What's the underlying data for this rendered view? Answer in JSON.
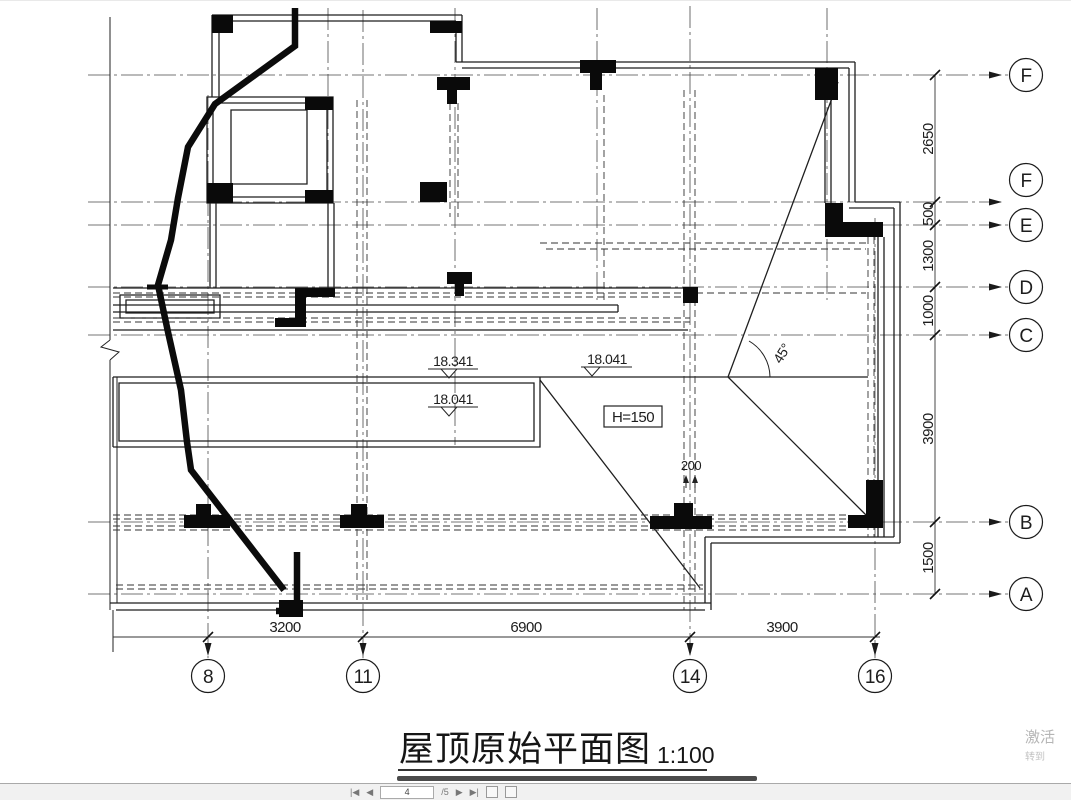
{
  "title": {
    "text": "屋顶原始平面图",
    "scale": "1:100"
  },
  "grid": {
    "rows": [
      "F",
      "F",
      "E",
      "D",
      "C",
      "B",
      "A"
    ],
    "cols": [
      "8",
      "11",
      "14",
      "16"
    ]
  },
  "dims": {
    "right": [
      "2650",
      "500",
      "1300",
      "1000",
      "3900",
      "1500"
    ],
    "bottom": [
      "3200",
      "6900",
      "3900"
    ],
    "gap": "200"
  },
  "annotations": {
    "levels": [
      "18.341",
      "18.041",
      "18.041"
    ],
    "height_note": "H=150",
    "angle_note": "45°"
  },
  "toolbar": {
    "first": "|◀",
    "prev": "◀",
    "page": "4",
    "of": "/5",
    "next": "▶",
    "last": "▶|"
  },
  "watermark": {
    "line1": "激活",
    "line2": "转到"
  }
}
